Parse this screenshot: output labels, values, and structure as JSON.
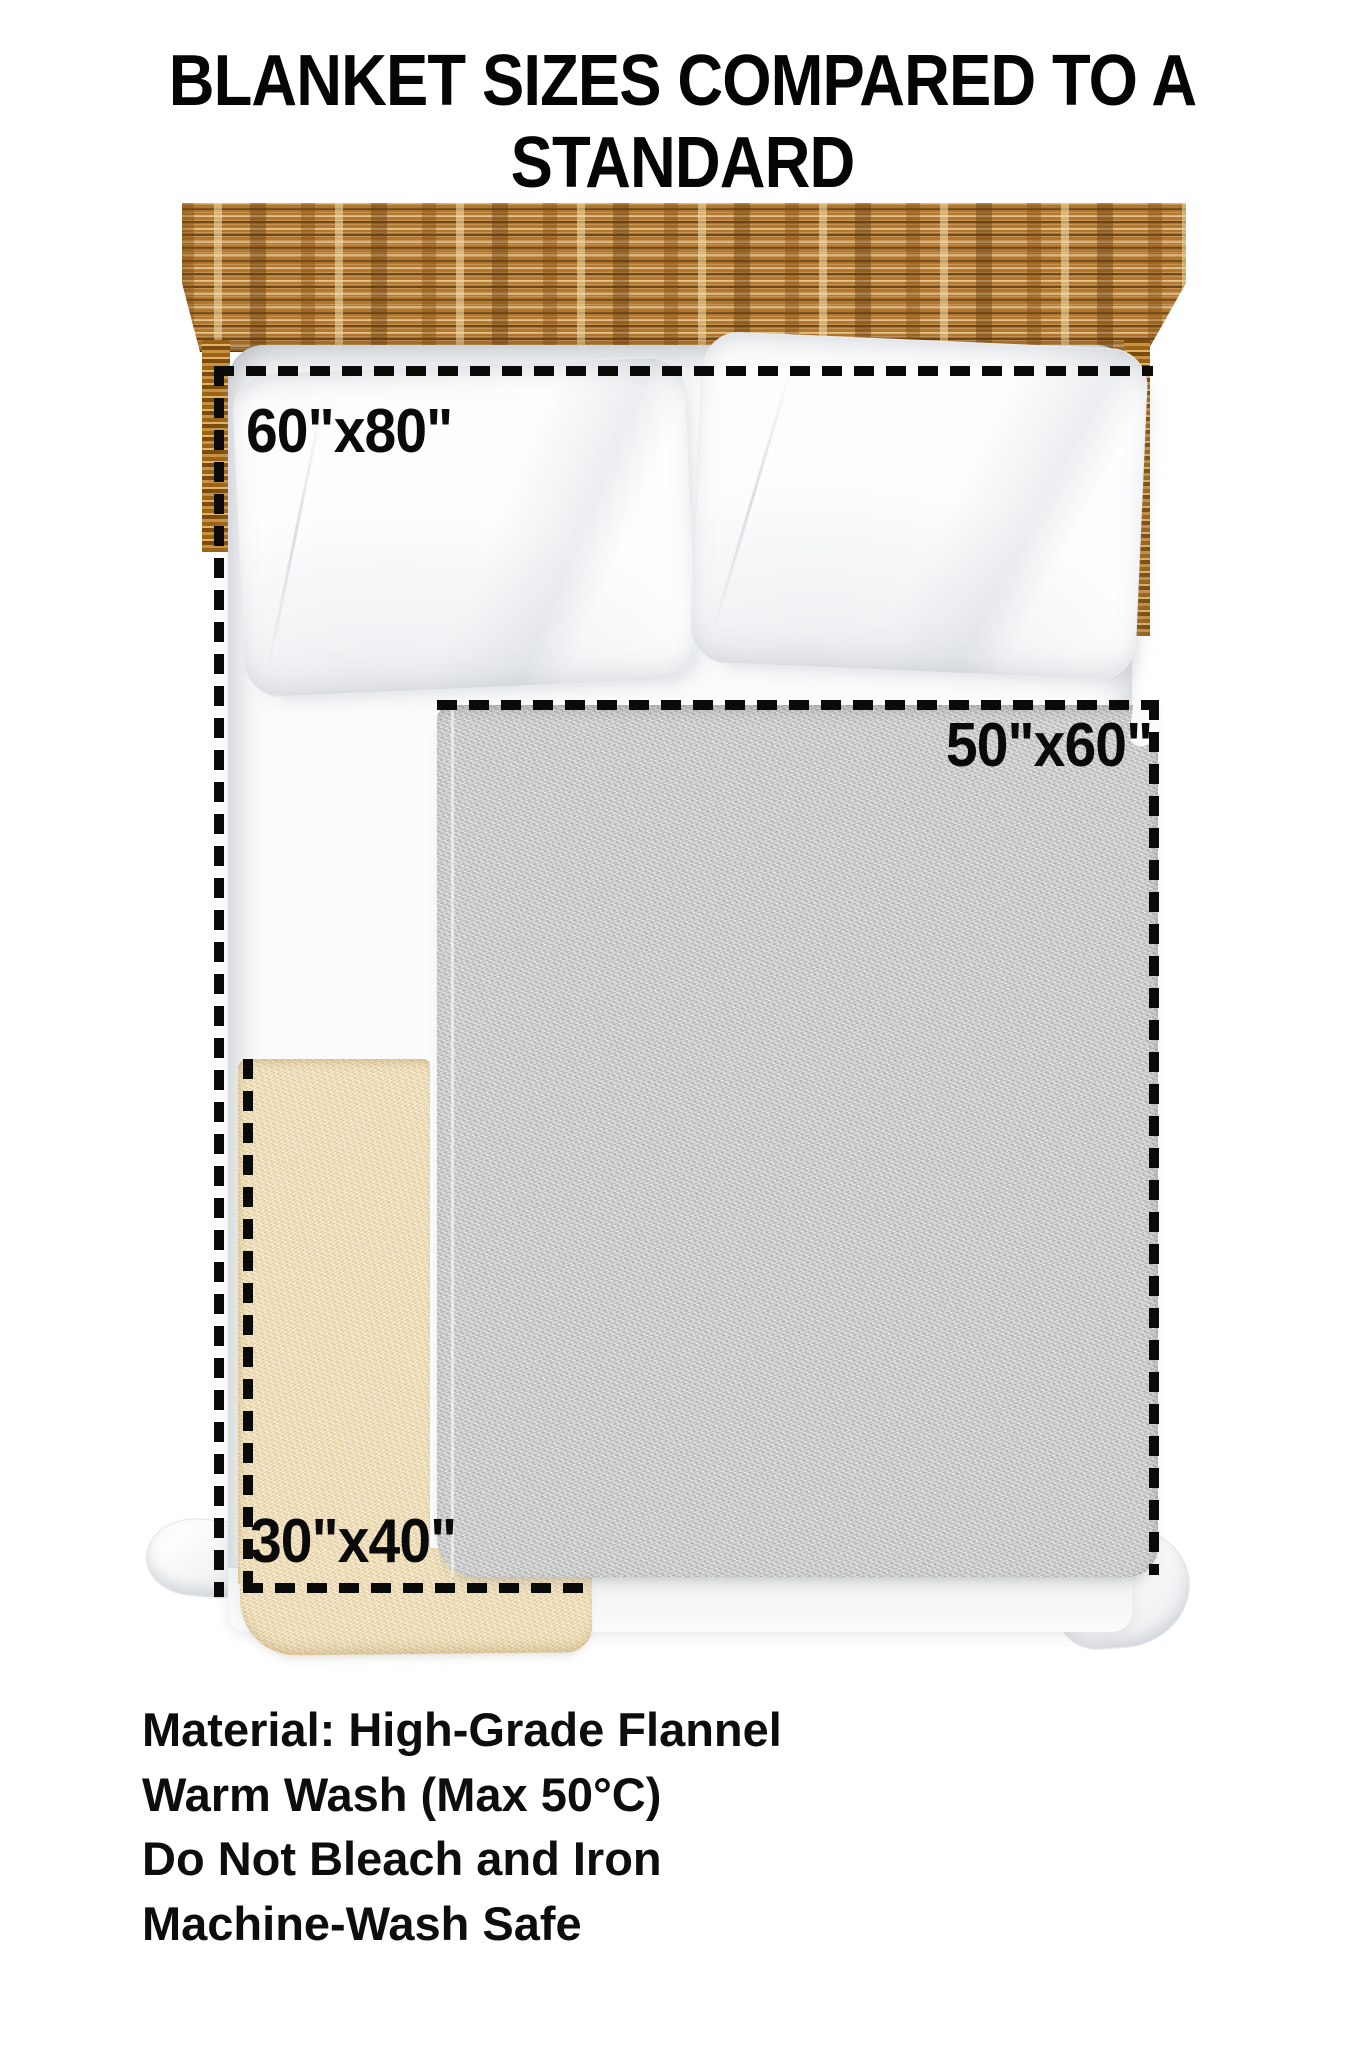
{
  "title": {
    "line1": "BLANKET SIZES COMPARED TO A STANDARD",
    "line2": "QUEEN SIZE BED"
  },
  "diagram": {
    "blankets": [
      {
        "id": "blanket-60x80",
        "size_label": "60\"x80\""
      },
      {
        "id": "blanket-50x60",
        "size_label": "50\"x60\""
      },
      {
        "id": "blanket-30x40",
        "size_label": "30\"x40\""
      }
    ],
    "colors": {
      "headboard_wood": "#b5772a",
      "blanket_50x60": "#c6c8c7",
      "blanket_30x40": "#eedcb6",
      "outline_dash": "#0a0a0a",
      "text": "#0d0d0d",
      "background": "#ffffff"
    }
  },
  "care_instructions": [
    "Material: High-Grade Flannel",
    "Warm Wash (Max 50°C)",
    "Do Not Bleach and Iron",
    "Machine-Wash Safe"
  ]
}
